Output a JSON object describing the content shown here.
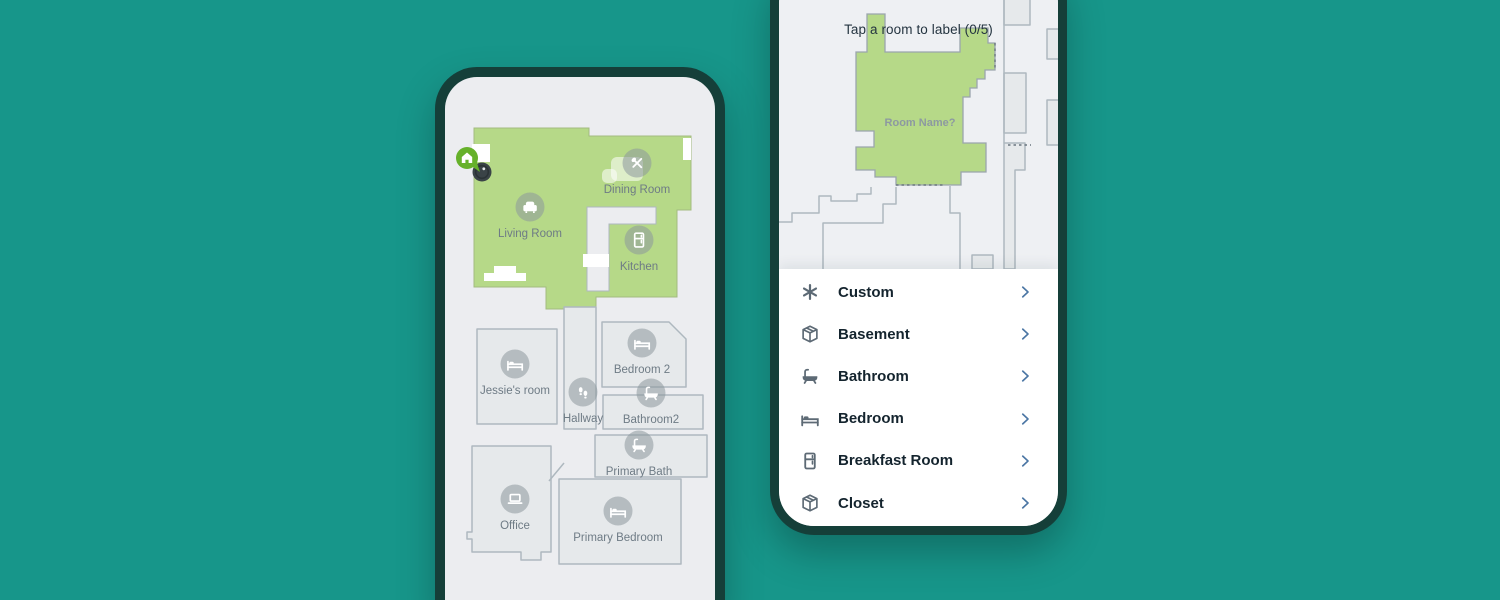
{
  "colors": {
    "background": "#17968a",
    "phone_frame": "#153f39",
    "screen_bg": "#ecedf0",
    "map_bg": "#eef0f3",
    "room_fill": "#e6e9eb",
    "room_stroke": "#aeb8bf",
    "green_room": "#b6d988",
    "green_stroke": "#a3bb80",
    "marker_fill": "#8d979d",
    "map_label": "#6e7b85",
    "header_text": "#243440",
    "room_name_text": "#8d99a1",
    "list_text": "#14242e",
    "list_icon": "#5d6a75",
    "chevron": "#4b76a4",
    "dock_green": "#66b12a",
    "robot_dark": "#3a4347"
  },
  "left_phone": {
    "map_markers": [
      {
        "label": "Living Room",
        "icon": "armchair",
        "x": 85,
        "y": 130
      },
      {
        "label": "Dining Room",
        "icon": "utensils",
        "x": 192,
        "y": 86
      },
      {
        "label": "Kitchen",
        "icon": "fridge",
        "x": 194,
        "y": 163
      },
      {
        "label": "Jessie's room",
        "icon": "bed",
        "x": 70,
        "y": 287
      },
      {
        "label": "Bedroom 2",
        "icon": "bed",
        "x": 197,
        "y": 266
      },
      {
        "label": "Hallway",
        "icon": "footprints",
        "x": 138,
        "y": 315
      },
      {
        "label": "Bathroom2",
        "icon": "bathtub",
        "x": 206,
        "y": 316
      },
      {
        "label": "Primary Bath",
        "icon": "bathtub",
        "x": 194,
        "y": 368
      },
      {
        "label": "Office",
        "icon": "laptop",
        "x": 70,
        "y": 422
      },
      {
        "label": "Primary Bedroom",
        "icon": "bed",
        "x": 173,
        "y": 434
      }
    ],
    "dock_icon": "home-pin",
    "robot_icon": "robot-vacuum"
  },
  "right_phone": {
    "header": "Tap a room to label (0/5)",
    "map_room_label": "Room Name?",
    "room_list": [
      {
        "icon": "asterisk",
        "label": "Custom"
      },
      {
        "icon": "cube",
        "label": "Basement"
      },
      {
        "icon": "bathtub",
        "label": "Bathroom"
      },
      {
        "icon": "bed",
        "label": "Bedroom"
      },
      {
        "icon": "fridge",
        "label": "Breakfast Room"
      },
      {
        "icon": "cube",
        "label": "Closet"
      }
    ]
  }
}
